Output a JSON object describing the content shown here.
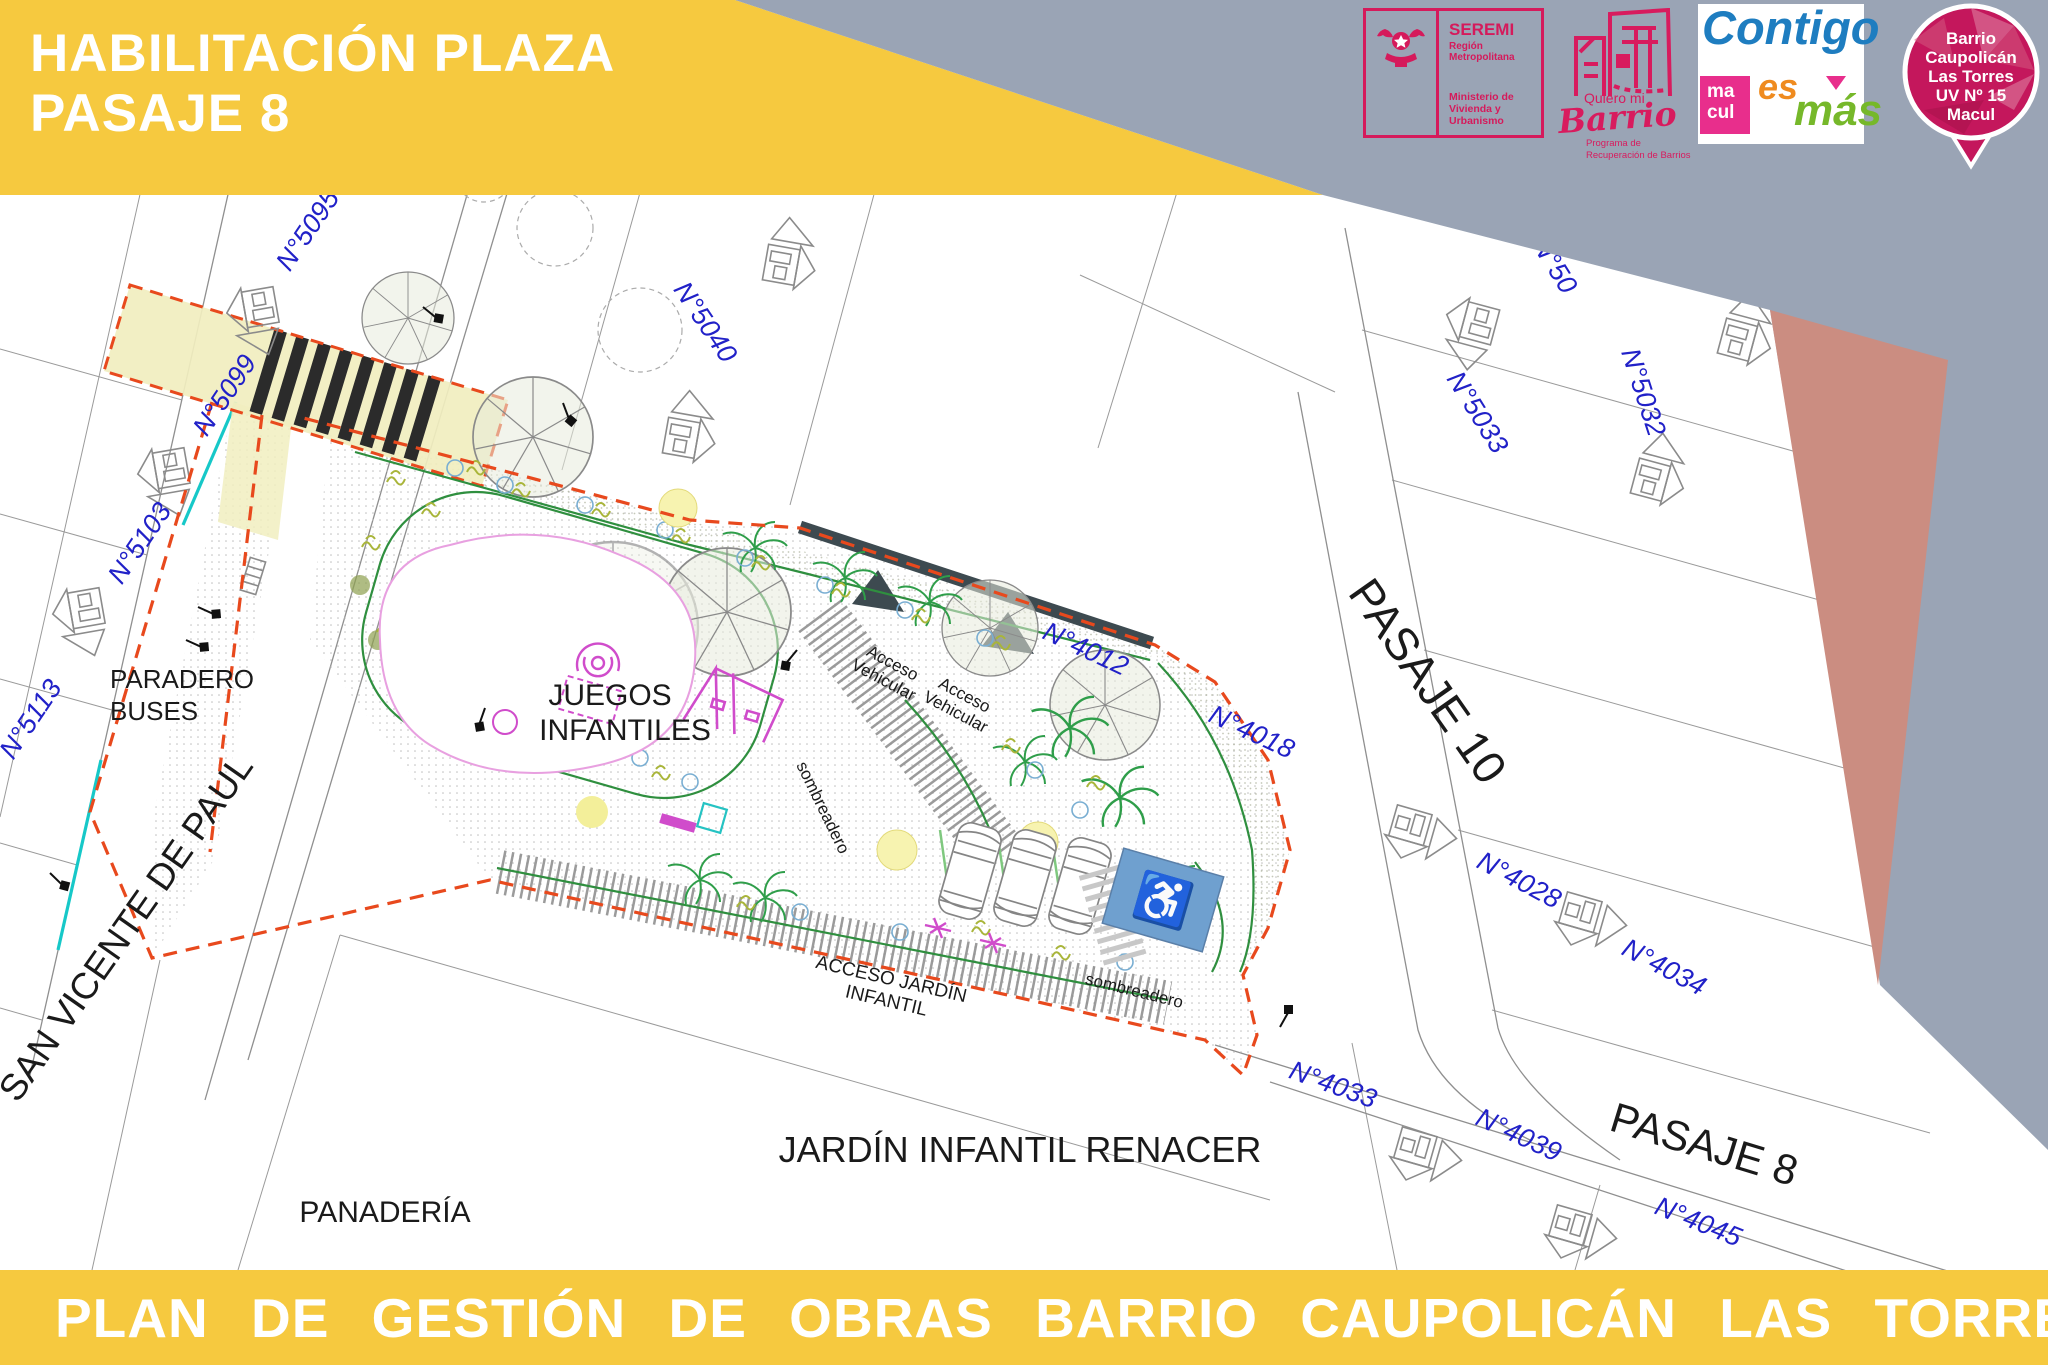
{
  "header": {
    "title_line1": "HABILITACIÓN PLAZA",
    "title_line2": "PASAJE 8"
  },
  "footer": {
    "text": "PLAN DE GESTIÓN DE OBRAS BARRIO CAUPOLICÁN LAS TORRES"
  },
  "logos": {
    "seremi": {
      "name": "SEREMI",
      "region": "Región Metropolitana",
      "ministry_line1": "Ministerio de",
      "ministry_line2": "Vivienda y",
      "ministry_line3": "Urbanismo"
    },
    "quiero_mi_barrio": {
      "tagline": "Quiero mi",
      "brand": "Barrio",
      "program_line1": "Programa de",
      "program_line2": "Recuperación de Barrios"
    },
    "contigo_es_mas": {
      "contigo": "Contigo",
      "macul_line1": "ma",
      "macul_line2": "cul",
      "es": "es",
      "mas": "más"
    },
    "badge": {
      "line1": "Barrio",
      "line2": "Caupolicán",
      "line3": "Las Torres",
      "line4": "UV Nº 15",
      "line5": "Macul"
    }
  },
  "plan": {
    "street_labels": {
      "san_vicente": "SAN VICENTE DE PAUL",
      "pasaje_10": "PASAJE 10",
      "pasaje_8": "PASAJE 8"
    },
    "area_labels": {
      "paradero_line1": "PARADERO",
      "paradero_line2": "BUSES",
      "panaderia": "PANADERÍA",
      "juegos_line1": "JUEGOS",
      "juegos_line2": "INFANTILES",
      "jardin_infantil": "JARDÍN INFANTIL RENACER",
      "acceso_jardin_line1": "ACCESO JARDÍN",
      "acceso_jardin_line2": "INFANTIL",
      "acceso_vehicular_line1": "Acceso",
      "acceso_vehicular_line2": "Vehicular",
      "sombreadero": "sombreadero"
    },
    "house_numbers": [
      {
        "text": "N°5095"
      },
      {
        "text": "N°5099"
      },
      {
        "text": "N°5103"
      },
      {
        "text": "N°5113"
      },
      {
        "text": "N°5040"
      },
      {
        "text": "N°50"
      },
      {
        "text": "N°5033"
      },
      {
        "text": "N°5032"
      },
      {
        "text": "N°4012"
      },
      {
        "text": "N°4018"
      },
      {
        "text": "N°4028"
      },
      {
        "text": "N°4034"
      },
      {
        "text": "N°4033"
      },
      {
        "text": "N°4039"
      },
      {
        "text": "N°4045"
      },
      {
        "text": "5"
      }
    ],
    "icons": {
      "wheelchair": "♿"
    },
    "colors": {
      "banner_yellow": "#F6C93F",
      "band_gray": "#9AA4B5",
      "band_salmon": "#CB8D81",
      "brand_crimson": "#D51A5B",
      "label_blue": "#2121C8",
      "boundary_red": "#E8491D",
      "path_green": "#2F8F3F",
      "play_magenta": "#D04CCB",
      "handicap_blue": "#6FA0CF",
      "cyan_curb": "#16C8C8"
    }
  }
}
